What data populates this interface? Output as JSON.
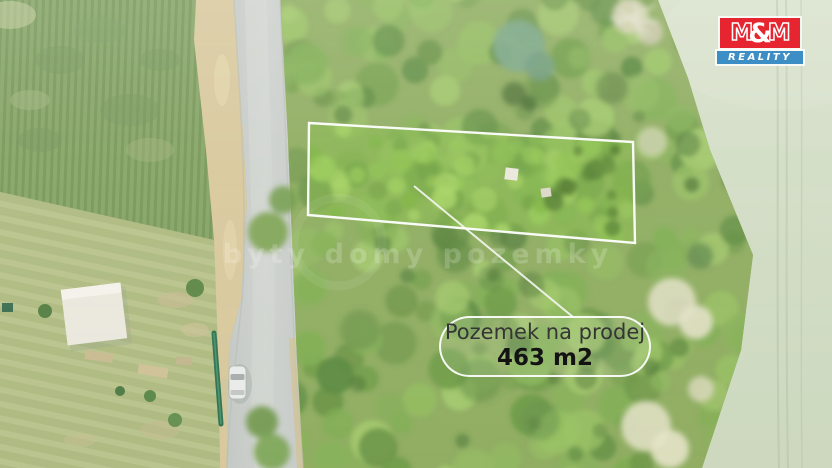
{
  "badge": {
    "title": "Pozemek na prodej",
    "area": "463 m2"
  },
  "watermark": {
    "text": "byty domy pozemky"
  },
  "brand": {
    "m_left": "M",
    "ampersand": "&",
    "m_right": "M",
    "subtitle": "REALITY",
    "red": "#e62530",
    "blue": "#3e8ec6"
  },
  "photo": {
    "plot_outline_color": "#ffffff"
  }
}
